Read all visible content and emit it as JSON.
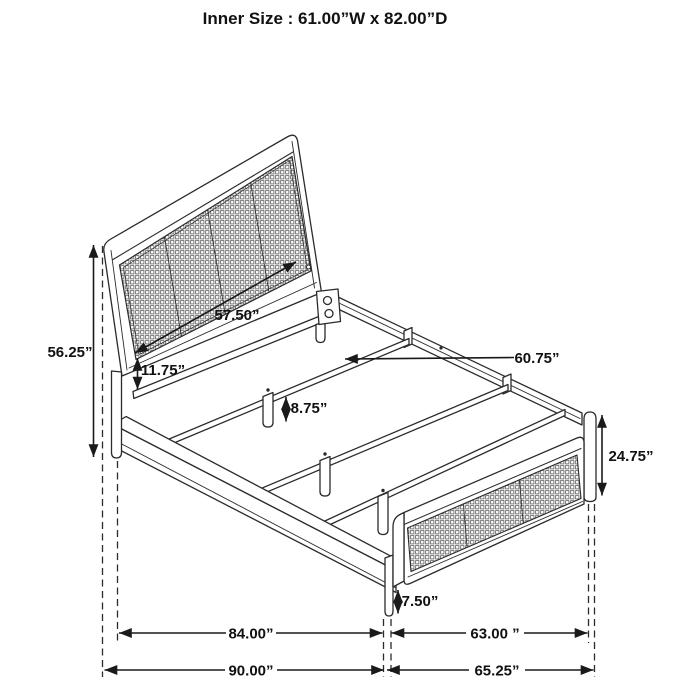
{
  "title": "Inner Size : 61.00”W x 82.00”D",
  "diagram": {
    "subject": "isometric line drawing of a bed frame with cane-webbing headboard and footboard, metal slat base and dimension callouts",
    "inner_size": {
      "width": "61.00”W",
      "depth": "82.00”D"
    }
  },
  "labels": {
    "headboard_height": "56.25”",
    "headboard_width": "57.50”",
    "headboard_rail_gap": "11.75”",
    "slat_length": "60.75”",
    "slat_leg_height": "8.75”",
    "footboard_height": "24.75”",
    "footboard_clearance": "7.50”",
    "inner_length": "84.00”",
    "foot_inner_width": "63.00 ”",
    "overall_length": "90.00”",
    "foot_overall_width": "65.25”"
  },
  "colors": {
    "background": "#ffffff",
    "line": "#2b2b2b",
    "dimension_line": "#1a1a1a",
    "text": "#111111",
    "mesh_line": "#6f6f6f"
  }
}
